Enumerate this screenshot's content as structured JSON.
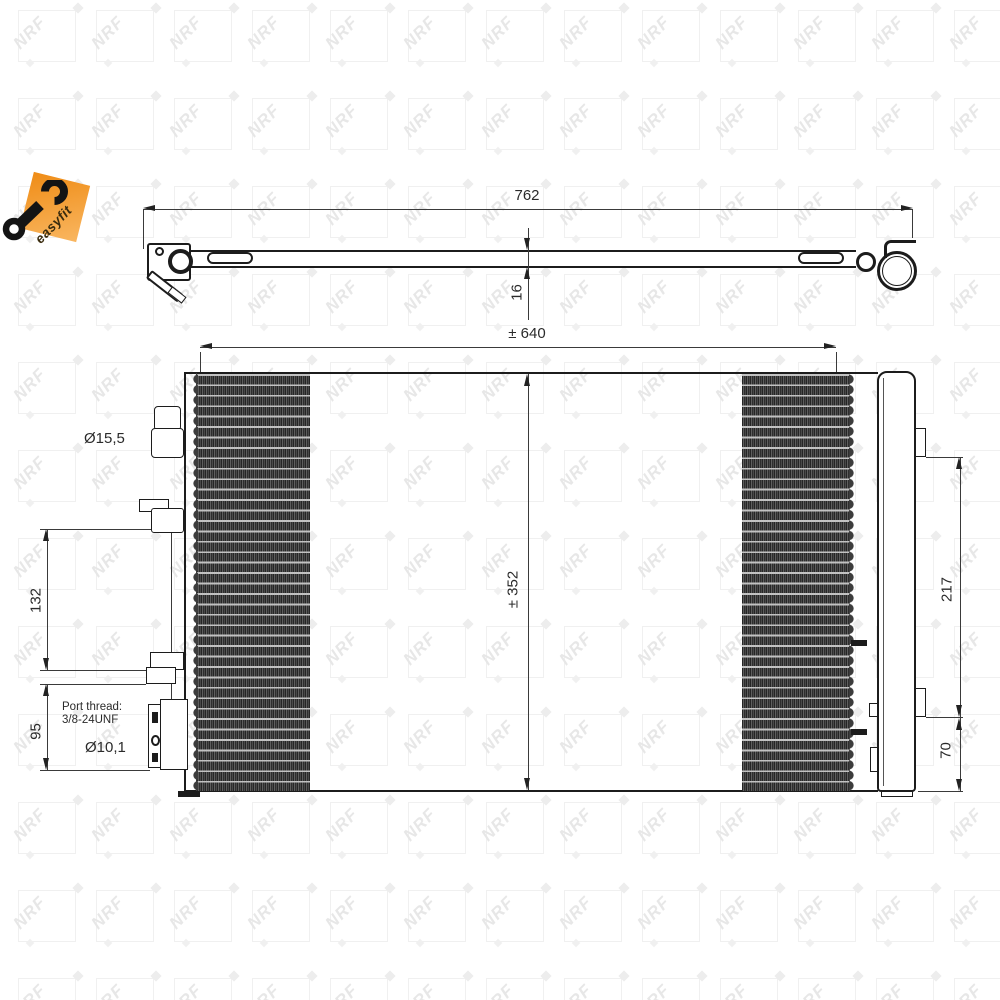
{
  "logo": {
    "label": "easyfit"
  },
  "watermark": {
    "text": "NRF",
    "cols": 13,
    "rows": 12
  },
  "side_view": {
    "overall_width": "762",
    "thickness": "16"
  },
  "front_view": {
    "core_width": "± 640",
    "core_height": "± 352",
    "top_port_diameter": "Ø15,5",
    "upper_mount_spacing": "132",
    "lower_mount_spacing": "95",
    "port_thread_label": "Port thread:",
    "port_thread_value": "3/8-24UNF",
    "bottom_port_diameter": "Ø10,1",
    "receiver_drier_length": "217",
    "receiver_drier_bottom_offset": "70"
  }
}
